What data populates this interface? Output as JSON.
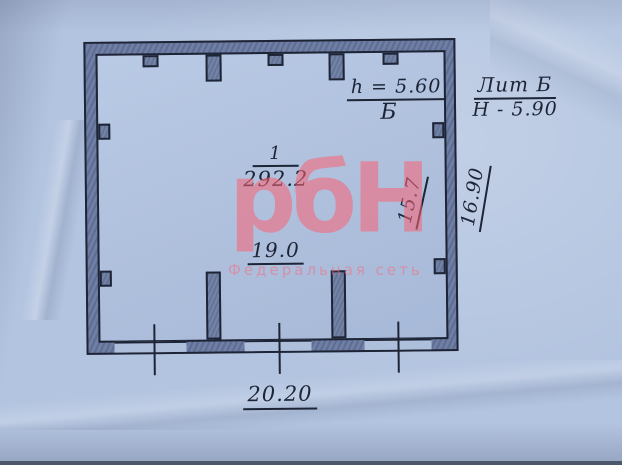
{
  "room": {
    "number": "1",
    "area": "292.2"
  },
  "notes": {
    "height_note": "h = 5.60",
    "height_note_letter": "Б",
    "litera": "Лит Б",
    "building_height": "Н - 5.90"
  },
  "dimensions": {
    "interior_width": "19.0",
    "interior_depth": "15.7",
    "exterior_depth": "16.90",
    "exterior_width": "20.20"
  },
  "watermark": {
    "logo": "рбН",
    "subtitle": "Федеральная сеть"
  },
  "colors": {
    "paper": "#b3c4e0",
    "ink": "#1d2436",
    "wall_fill": "#6e7ea4",
    "watermark_pink": "#db8ea3"
  }
}
